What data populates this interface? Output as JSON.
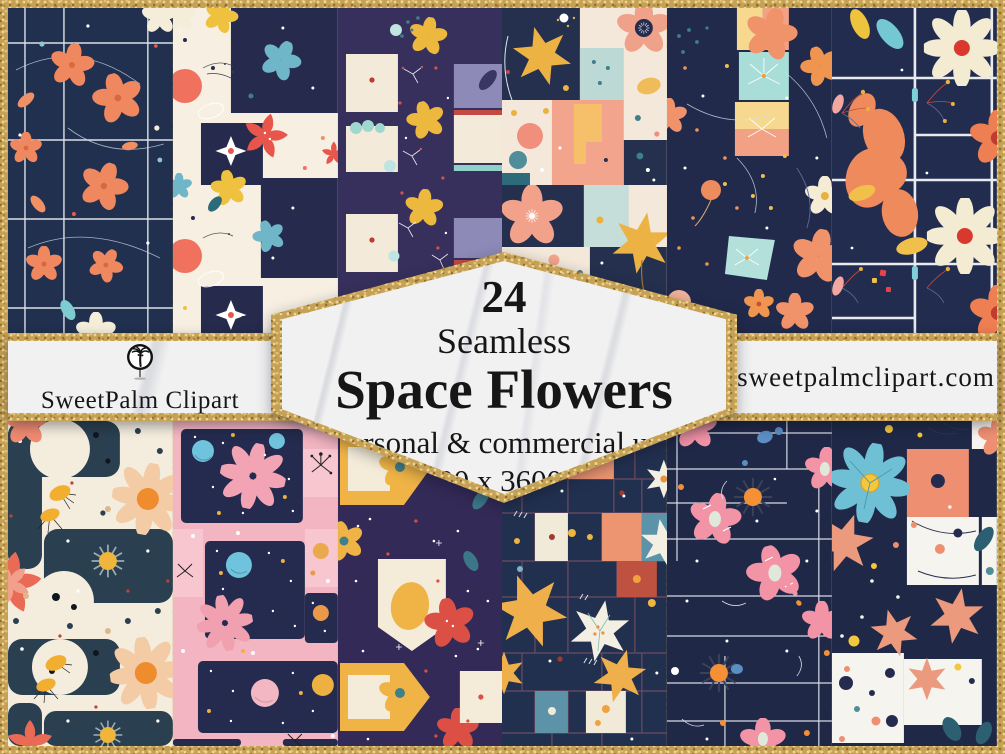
{
  "badge": {
    "count": "24",
    "subtitle": "Seamless",
    "title": "Space Flowers",
    "usage": "personal & commercial use",
    "size": "3600 x 3600 px"
  },
  "brand": {
    "name": "SweetPalm Clipart",
    "logo": "palm-tree-icon"
  },
  "website": {
    "url": "sweetpalmclipart.com"
  },
  "colors": {
    "gold_glitter": "#c5a156",
    "marble_white": "#f1f1f2",
    "navy": "#222c4e",
    "purple": "#35305c",
    "cream": "#f5eedf",
    "coral": "#ef8a61",
    "red": "#dc4f44",
    "yellow": "#eeb541",
    "pink": "#f3b5c1",
    "blue": "#6fc0d4",
    "text_ink": "#161616"
  },
  "pattern_tiles": {
    "top": [
      {
        "id": "tile-01",
        "desc": "navy grid with coral blossoms"
      },
      {
        "id": "tile-02",
        "desc": "cream checkerboard with red, yellow and blue flowers"
      },
      {
        "id": "tile-03",
        "desc": "purple patch squares with yellow flowers and sparkles"
      },
      {
        "id": "tile-04",
        "desc": "peach and navy patchwork with yellow lilies"
      },
      {
        "id": "tile-05",
        "desc": "navy with coral flowers and pastel squares"
      },
      {
        "id": "tile-06",
        "desc": "navy window grid with cream daisies and orange petals"
      }
    ],
    "bottom": [
      {
        "id": "tile-07",
        "desc": "cream with navy blobs, starbursts and peach daisies"
      },
      {
        "id": "tile-08",
        "desc": "pink space windows with planets and stars"
      },
      {
        "id": "tile-09",
        "desc": "purple with yellow houses and red flowers"
      },
      {
        "id": "tile-10",
        "desc": "navy mosaic grid with yellow iris and white lilies"
      },
      {
        "id": "tile-11",
        "desc": "navy staff lines with pink blossoms and orange suns"
      },
      {
        "id": "tile-12",
        "desc": "navy and white patch squares with blue daisy"
      }
    ]
  }
}
